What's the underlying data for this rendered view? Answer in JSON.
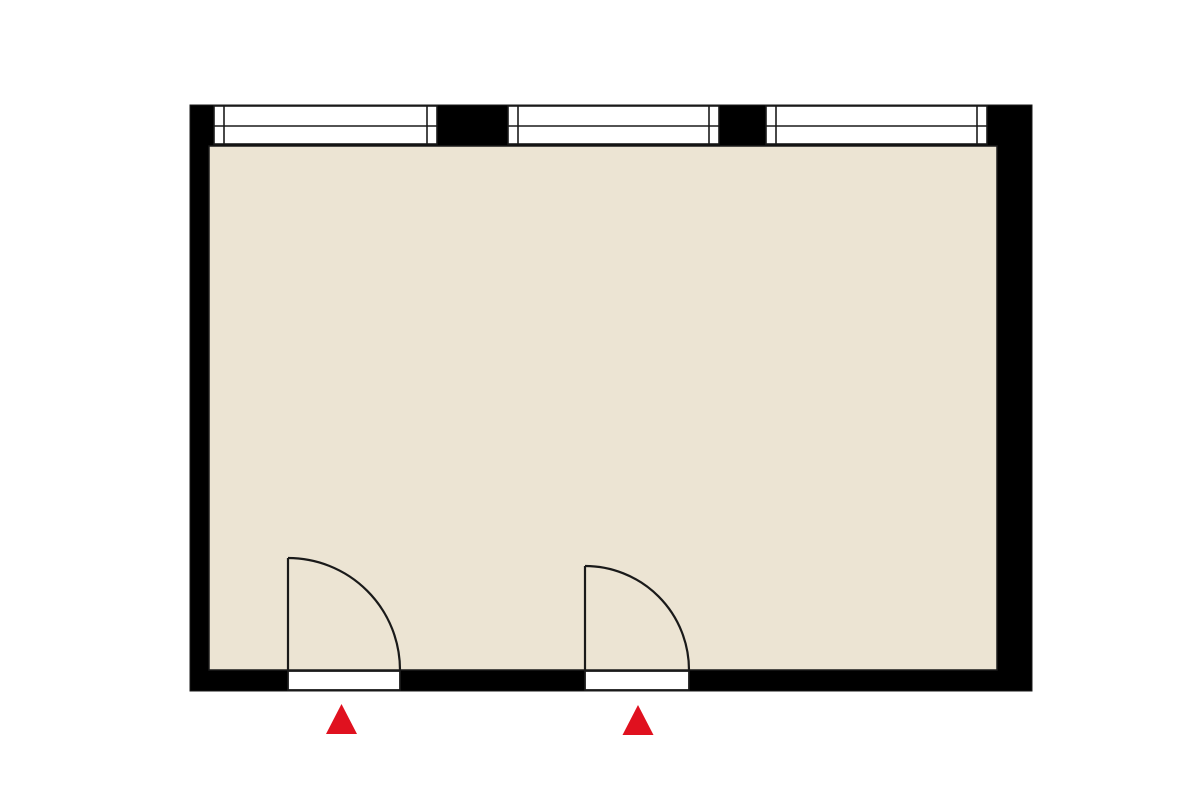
{
  "canvas": {
    "width": 1200,
    "height": 800,
    "background": "#ffffff"
  },
  "floor_plan": {
    "kind": "single-room top-down floor plan",
    "colors": {
      "wall": "#000000",
      "wall_edge": "#1a1a1a",
      "floor": "#ece4d3",
      "line": "#1a1a1a",
      "window_fill": "#ffffff",
      "door_fill": "#ffffff",
      "entrance_marker": "#e0111f"
    },
    "stroke_widths": {
      "floor_outline": 1.5,
      "window_frame": 1.6,
      "door_frame": 1.8,
      "door_symbol": 2.2
    },
    "outer_wall": {
      "x": 190,
      "y": 105,
      "width": 842,
      "height": 586
    },
    "floor": {
      "x": 209,
      "y": 146,
      "width": 788,
      "height": 524
    },
    "windows": [
      {
        "id": "window-1",
        "x1": 214,
        "x2": 437,
        "y1": 106,
        "y2": 144,
        "mid_y": 126,
        "post_width": 10
      },
      {
        "id": "window-2",
        "x1": 508,
        "x2": 719,
        "y1": 106,
        "y2": 144,
        "mid_y": 126,
        "post_width": 10
      },
      {
        "id": "window-3",
        "x1": 766,
        "x2": 987,
        "y1": 106,
        "y2": 144,
        "mid_y": 126,
        "post_width": 10
      }
    ],
    "doors": [
      {
        "id": "door-1",
        "opening": {
          "x1": 288,
          "x2": 400,
          "y1": 671,
          "y2": 690
        },
        "hinge": {
          "x": 288,
          "y": 670
        },
        "swing_radius": 112,
        "leaf_top_y": 558
      },
      {
        "id": "door-2",
        "opening": {
          "x1": 585,
          "x2": 689,
          "y1": 671,
          "y2": 690
        },
        "hinge": {
          "x": 585,
          "y": 670
        },
        "swing_radius": 104,
        "leaf_top_y": 566
      }
    ],
    "entrance_markers": [
      {
        "id": "entrance-marker-1",
        "cx": 341.5,
        "top_y": 704,
        "bottom_y": 734,
        "half_width": 15.5
      },
      {
        "id": "entrance-marker-2",
        "cx": 638,
        "top_y": 705,
        "bottom_y": 735,
        "half_width": 15.5
      }
    ]
  }
}
